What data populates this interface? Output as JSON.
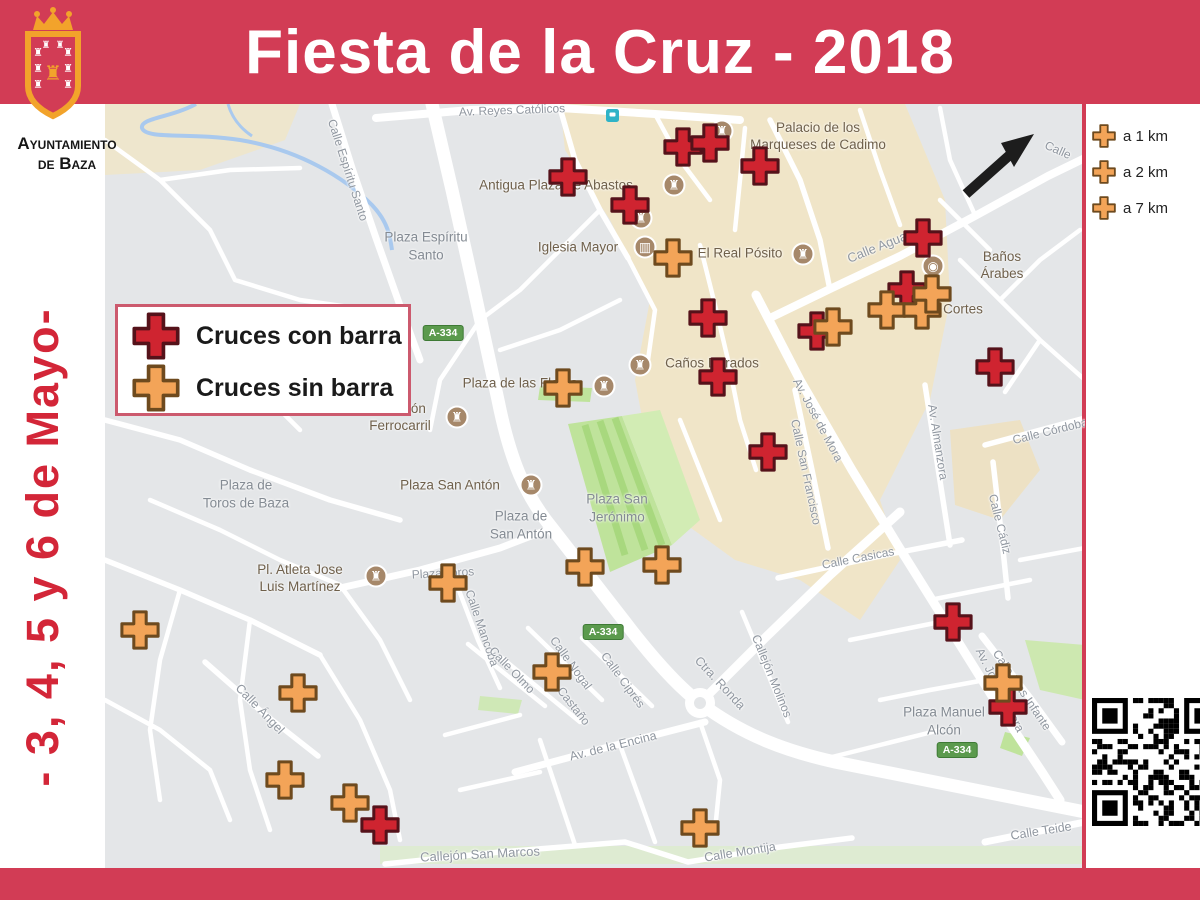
{
  "title": "Fiesta de la Cruz - 2018",
  "logo": {
    "org_line1": "Ayuntamiento",
    "org_line2": "de Baza"
  },
  "sidebar": {
    "dates_text": "- 3, 4, 5 y 6  de Mayo-"
  },
  "colors": {
    "banner_red": "#d23c55",
    "date_red": "#d32638",
    "cross_red_fill": "#cf2430",
    "cross_red_border": "#55121a",
    "cross_orange_fill": "#f3a458",
    "cross_orange_border": "#6e4a1e",
    "legend_border": "#cc5a6e",
    "shield_green": "#5b9a4d"
  },
  "legend": {
    "items": [
      {
        "type": "red",
        "label": "Cruces con barra"
      },
      {
        "type": "orange",
        "label": "Cruces sin barra"
      }
    ]
  },
  "distance_legend": {
    "items": [
      {
        "type": "orange",
        "label": "a 1 km"
      },
      {
        "type": "orange",
        "label": "a 2 km"
      },
      {
        "type": "orange",
        "label": "a 7 km"
      }
    ]
  },
  "map": {
    "road_shield_text": "A-334",
    "road_shields": [
      {
        "x": 443,
        "y": 333
      },
      {
        "x": 603,
        "y": 632
      },
      {
        "x": 957,
        "y": 750
      }
    ],
    "street_labels": [
      {
        "t": "Av. Reyes Católicos",
        "x": 512,
        "y": 110,
        "r": -2,
        "s": 12
      },
      {
        "t": "Calle Espíritu Santo",
        "x": 348,
        "y": 170,
        "r": 72,
        "s": 12
      },
      {
        "t": "Calle Agua",
        "x": 877,
        "y": 247,
        "r": -22,
        "s": 13
      },
      {
        "t": "Calle",
        "x": 1058,
        "y": 150,
        "r": 24,
        "s": 12
      },
      {
        "t": "Av. José de Mora",
        "x": 818,
        "y": 420,
        "r": 62,
        "s": 12
      },
      {
        "t": "Calle San Francisco",
        "x": 806,
        "y": 472,
        "r": 78,
        "s": 12
      },
      {
        "t": "Av. Almanzora",
        "x": 938,
        "y": 442,
        "r": 81,
        "s": 12
      },
      {
        "t": "Calle Cádiz",
        "x": 1000,
        "y": 524,
        "r": 76,
        "s": 12
      },
      {
        "t": "Calle Córdoba",
        "x": 1050,
        "y": 431,
        "r": -14,
        "s": 12
      },
      {
        "t": "Calle Casicas",
        "x": 858,
        "y": 558,
        "r": -11,
        "s": 12
      },
      {
        "t": "Calle Mancoba",
        "x": 482,
        "y": 628,
        "r": 71,
        "s": 12
      },
      {
        "t": "Calle Nogal",
        "x": 571,
        "y": 663,
        "r": 54,
        "s": 12
      },
      {
        "t": "Calle Ciprés",
        "x": 623,
        "y": 680,
        "r": 54,
        "s": 12
      },
      {
        "t": "Calle Olmo",
        "x": 512,
        "y": 670,
        "r": 46,
        "s": 12
      },
      {
        "t": "C. Castaño",
        "x": 569,
        "y": 700,
        "r": 52,
        "s": 12
      },
      {
        "t": "Av. de la Encina",
        "x": 613,
        "y": 746,
        "r": -14,
        "s": 12.5
      },
      {
        "t": "Ctra. Ronda",
        "x": 720,
        "y": 683,
        "r": 47,
        "s": 12.5
      },
      {
        "t": "Callejón Molinos",
        "x": 772,
        "y": 676,
        "r": 68,
        "s": 12
      },
      {
        "t": "Calle Montija",
        "x": 740,
        "y": 852,
        "r": -9,
        "s": 12.5
      },
      {
        "t": "Callejón San Marcos",
        "x": 480,
        "y": 854,
        "r": -3,
        "s": 13
      },
      {
        "t": "Calle Ángel",
        "x": 260,
        "y": 709,
        "r": 46,
        "s": 12.5
      },
      {
        "t": "Calle Blas Infante",
        "x": 1022,
        "y": 690,
        "r": 56,
        "s": 12
      },
      {
        "t": "Av. José de Mora",
        "x": 1000,
        "y": 690,
        "r": 63,
        "s": 12
      },
      {
        "t": "Calle Teide",
        "x": 1041,
        "y": 831,
        "r": -9,
        "s": 12.5
      },
      {
        "t": "Plaza Toros",
        "x": 443,
        "y": 573,
        "r": -3,
        "s": 12
      }
    ],
    "plaza_labels": [
      {
        "t": "Plaza Espíritu\nSanto",
        "x": 426,
        "y": 246
      },
      {
        "t": "Plaza de\nToros de Baza",
        "x": 246,
        "y": 494
      },
      {
        "t": "Plaza San\nJerónimo",
        "x": 617,
        "y": 508
      },
      {
        "t": "Plaza de\nSan Antón",
        "x": 521,
        "y": 525
      },
      {
        "t": "Plaza Manuel\nAlcón",
        "x": 944,
        "y": 721
      }
    ],
    "pois": [
      {
        "n": "Palacio de los\nMarqueses de Cadimo",
        "ix": 722,
        "iy": 131,
        "lx": 818,
        "ly": 137,
        "g": "♜"
      },
      {
        "n": "Antigua Plaza de Abastos",
        "ix": 674,
        "iy": 185,
        "lx": 556,
        "ly": 186,
        "g": "♜"
      },
      {
        "n": "",
        "ix": 641,
        "iy": 218,
        "lx": 0,
        "ly": 0,
        "g": "♜"
      },
      {
        "n": "Iglesia Mayor",
        "ix": 645,
        "iy": 247,
        "lx": 578,
        "ly": 248,
        "g": "▥"
      },
      {
        "n": "El Real Pósito",
        "ix": 803,
        "iy": 254,
        "lx": 740,
        "ly": 254,
        "g": "♜"
      },
      {
        "n": "Caños Dorados",
        "ix": 640,
        "iy": 365,
        "lx": 712,
        "ly": 364,
        "g": "♜"
      },
      {
        "n": "Plaza de las Flores",
        "ix": 604,
        "iy": 386,
        "lx": 520,
        "ly": 384,
        "g": "♜"
      },
      {
        "n": "Estación\nFerrocarril",
        "ix": 457,
        "iy": 417,
        "lx": 400,
        "ly": 418,
        "g": "♜"
      },
      {
        "n": "Plaza San Antón",
        "ix": 531,
        "iy": 485,
        "lx": 450,
        "ly": 486,
        "g": "♜"
      },
      {
        "n": "Pl. Atleta Jose\nLuis Martínez",
        "ix": 376,
        "iy": 576,
        "lx": 300,
        "ly": 579,
        "g": "♜"
      },
      {
        "n": "Baños Árabes",
        "ix": 933,
        "iy": 266,
        "lx": 1002,
        "ly": 266,
        "g": "◉"
      },
      {
        "n": "Cortes",
        "ix": null,
        "iy": null,
        "lx": 963,
        "ly": 310,
        "g": ""
      }
    ],
    "markers": {
      "red": [
        [
          683,
          147
        ],
        [
          710,
          143
        ],
        [
          760,
          166
        ],
        [
          568,
          177
        ],
        [
          630,
          205
        ],
        [
          923,
          238
        ],
        [
          907,
          290
        ],
        [
          817,
          331
        ],
        [
          708,
          318
        ],
        [
          718,
          377
        ],
        [
          995,
          367
        ],
        [
          768,
          452
        ],
        [
          953,
          622
        ],
        [
          1008,
          707
        ],
        [
          380,
          825
        ]
      ],
      "orange": [
        [
          673,
          258
        ],
        [
          563,
          388
        ],
        [
          833,
          327
        ],
        [
          887,
          310
        ],
        [
          922,
          310
        ],
        [
          932,
          294
        ],
        [
          448,
          583
        ],
        [
          585,
          567
        ],
        [
          662,
          565
        ],
        [
          140,
          630
        ],
        [
          298,
          693
        ],
        [
          285,
          780
        ],
        [
          350,
          803
        ],
        [
          552,
          672
        ],
        [
          700,
          828
        ],
        [
          1003,
          683
        ]
      ]
    }
  }
}
